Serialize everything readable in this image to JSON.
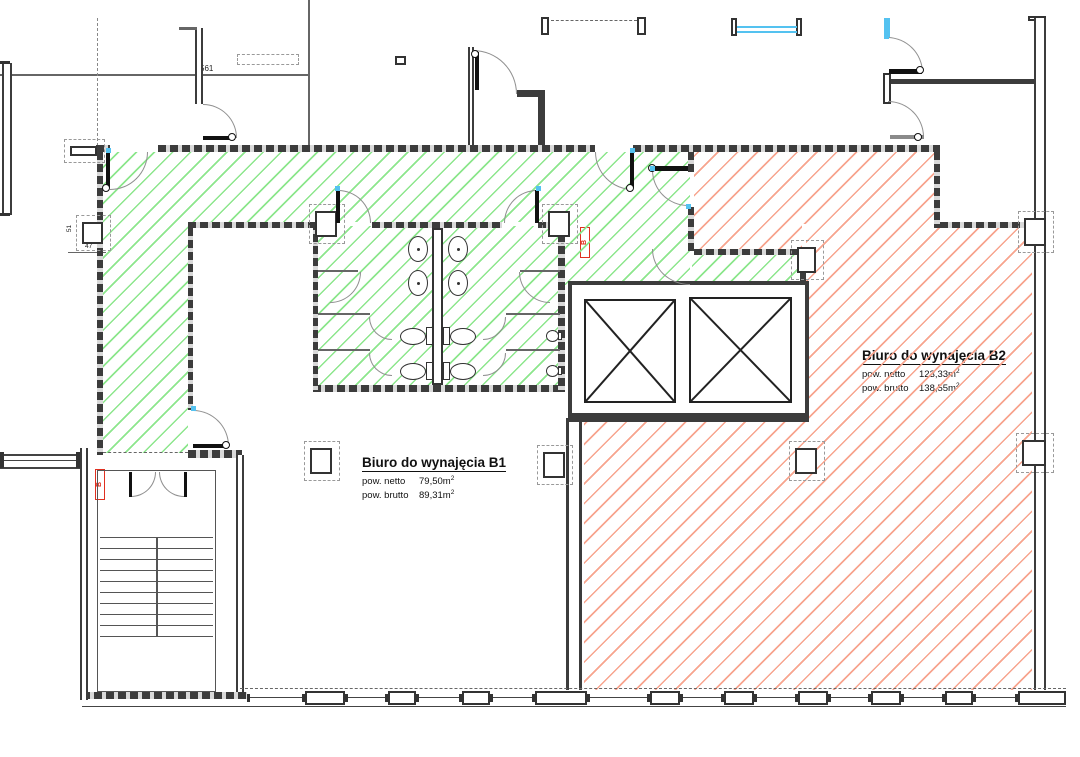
{
  "drawing": {
    "units": {
      "b1": {
        "title": "Biuro do wynajęcia B1",
        "netto_label": "pow. netto",
        "netto_value": "79,50m",
        "netto_sup": "2",
        "brutto_label": "pow. brutto",
        "brutto_value": "89,31m",
        "brutto_sup": "2"
      },
      "b2": {
        "title": "Biuro do wynajęcia B2",
        "netto_label": "pow. netto",
        "netto_value": "123,33m",
        "netto_sup": "2",
        "brutto_label": "pow. brutto",
        "brutto_value": "138,55m",
        "brutto_sup": "2"
      }
    },
    "dimensions": {
      "top_room_width": "561",
      "pier_height": "51",
      "pier_width": "47"
    },
    "markers": {
      "hydrant_b1": "B",
      "hydrant_b2": "B"
    },
    "colors": {
      "hatch_green": "#8CE68C",
      "hatch_red": "#F7A48E",
      "wall": "#3C3C3C",
      "window_blue": "#54C2F0",
      "marker_red": "#E03020"
    }
  }
}
